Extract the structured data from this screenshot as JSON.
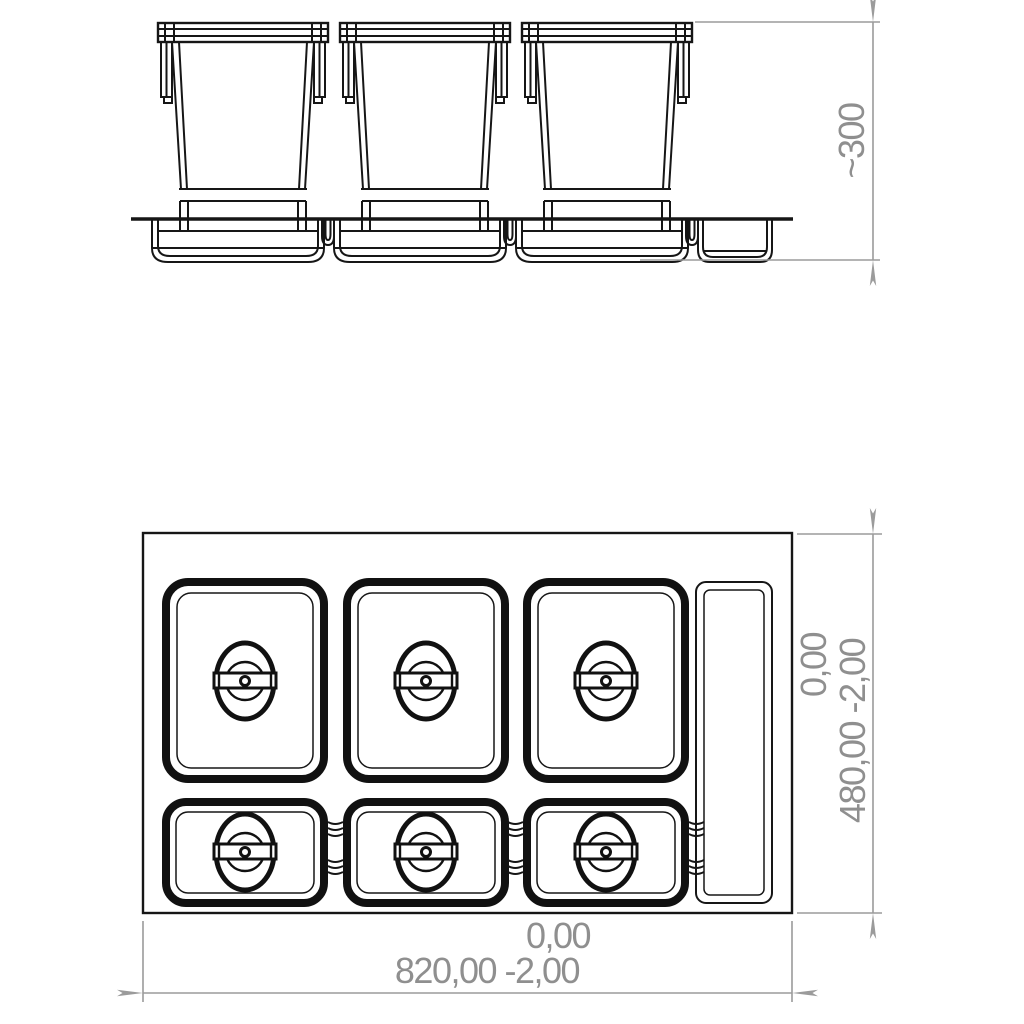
{
  "drawing": {
    "kind": "waste-bin-drawer-insert-technical-drawing",
    "colors": {
      "line": "#161616",
      "dimension_line": "#9b9b9b",
      "dimension_text": "#8f8f8f",
      "background": "#ffffff"
    },
    "side_view": {
      "bin_count": 3,
      "dimension_height": "~300"
    },
    "plan_view": {
      "lid_count": 6,
      "side_tray_count": 1,
      "dimension_depth_tolerance": "0,00",
      "dimension_depth": "480,00 -2,00",
      "dimension_width_tolerance": "0,00",
      "dimension_width": "820,00 -2,00"
    }
  }
}
